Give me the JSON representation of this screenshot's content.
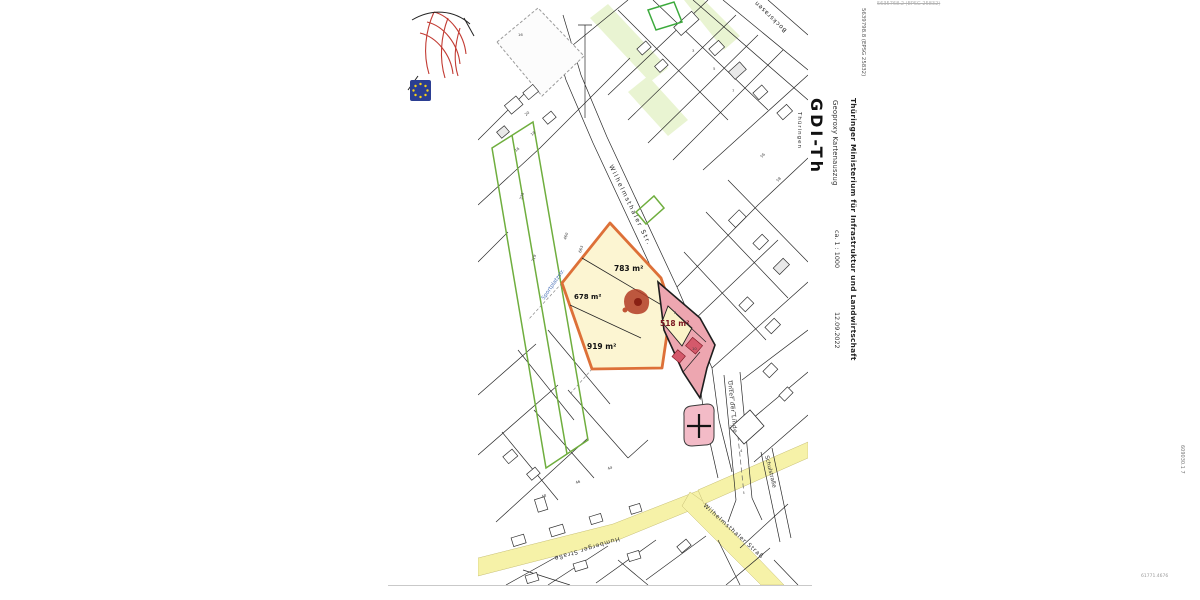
{
  "page": {
    "top_coordinate": "5635768.2 (EPSG 25832)",
    "left_coordinate": "5639798.8 (EPSG 25832)",
    "right_coordinate": "609030.1 7",
    "bottom_right_code": "61771.4676"
  },
  "logo": {
    "name": "GDI-Th",
    "region": "Thüringen"
  },
  "sidebar": {
    "ministry": "Thüringer Ministerium für Infrastruktur und Landwirtschaft",
    "product": "Geoproxy Kartenauszug",
    "scale": "ca. 1 : 1000",
    "date": "12.09.2022"
  },
  "map": {
    "areas": {
      "a783": "783 m²",
      "a678": "678 m²",
      "a919": "919 m²",
      "a518": "518 m²"
    },
    "streets": {
      "main": "Wilhelmsthaler Str.",
      "bottom": "Humberger Straße",
      "bottom_right": "Wilhelmsthaler Straß",
      "linde": "Unter der Linde",
      "schul": "Schulstraße",
      "top_right": "Bocksrasen",
      "waterway": "Sportplatzstr."
    },
    "small_labels": [
      "335",
      "719",
      "460",
      "663",
      "16",
      "18",
      "20",
      "16",
      "3",
      "5",
      "7",
      "58",
      "56",
      "48",
      "46",
      "44",
      "2",
      "4",
      "8",
      "10"
    ],
    "highlight_colors": {
      "parcel_outline": "#dd7038",
      "parcel_fill": "#fcf5d2",
      "pink_fill": "#eda6b0",
      "road_fill": "#f6f2a8",
      "green_outline": "#6fae3e",
      "label_red": "#7a1520"
    }
  }
}
